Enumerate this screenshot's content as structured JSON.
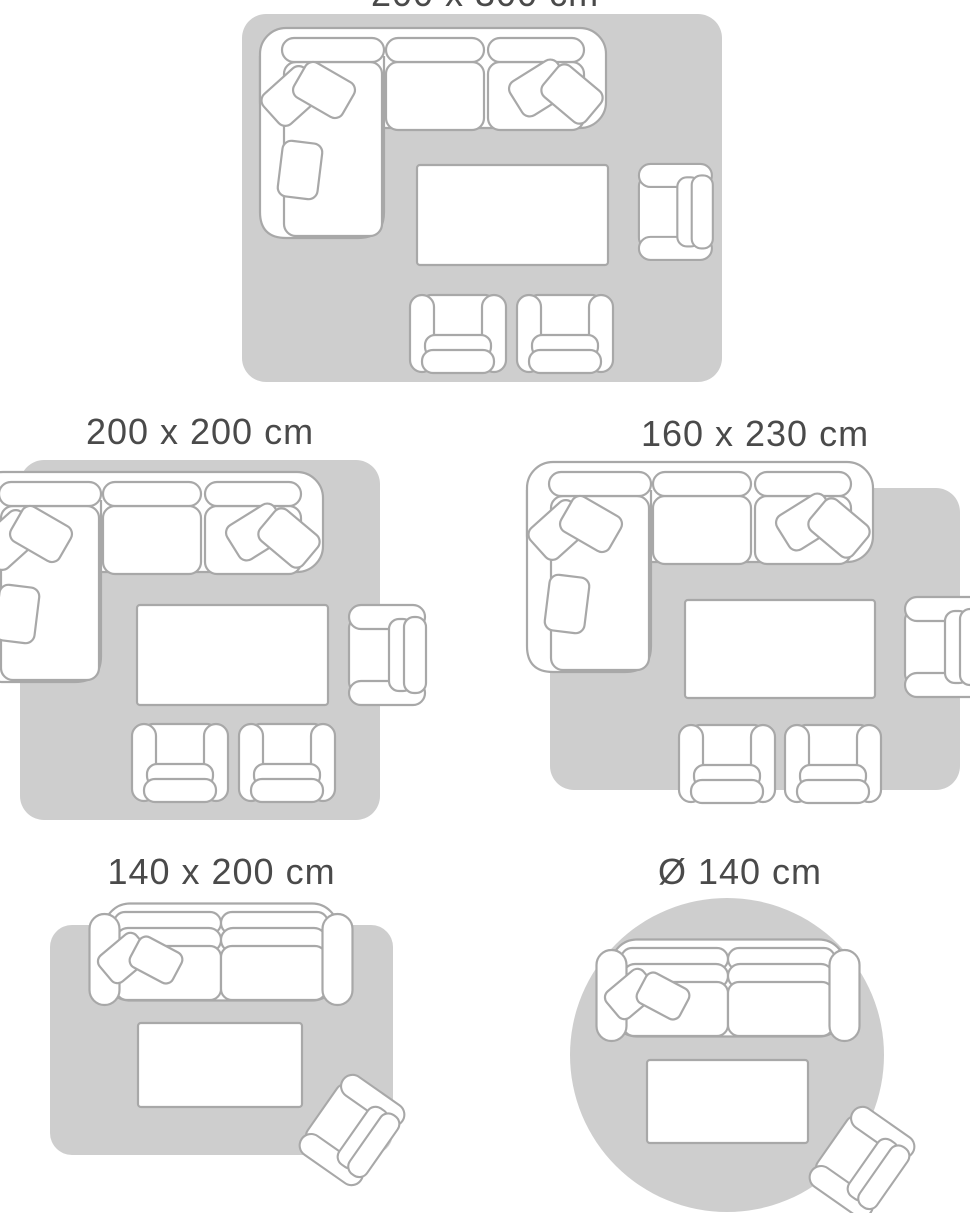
{
  "colors": {
    "background": "#ffffff",
    "rug_fill": "#cecece",
    "furniture_outline": "#a8a8a8",
    "furniture_fill": "#ffffff",
    "label_text": "#4a4a4a"
  },
  "layouts": [
    {
      "label": "200 x 300 cm",
      "rug_shape": "rectangle",
      "items": [
        "corner-sofa",
        "coffee-table",
        "armchair",
        "small-armchair",
        "small-armchair"
      ]
    },
    {
      "label": "200 x 200 cm",
      "rug_shape": "rectangle",
      "items": [
        "corner-sofa",
        "coffee-table",
        "armchair",
        "small-armchair",
        "small-armchair"
      ]
    },
    {
      "label": "160 x 230 cm",
      "rug_shape": "rectangle",
      "items": [
        "corner-sofa",
        "coffee-table",
        "armchair",
        "small-armchair",
        "small-armchair"
      ]
    },
    {
      "label": "140 x 200 cm",
      "rug_shape": "rectangle",
      "items": [
        "two-seat-sofa",
        "coffee-table",
        "armchair"
      ]
    },
    {
      "label": "Ø 140 cm",
      "rug_shape": "circle",
      "items": [
        "two-seat-sofa",
        "coffee-table",
        "armchair"
      ]
    }
  ]
}
